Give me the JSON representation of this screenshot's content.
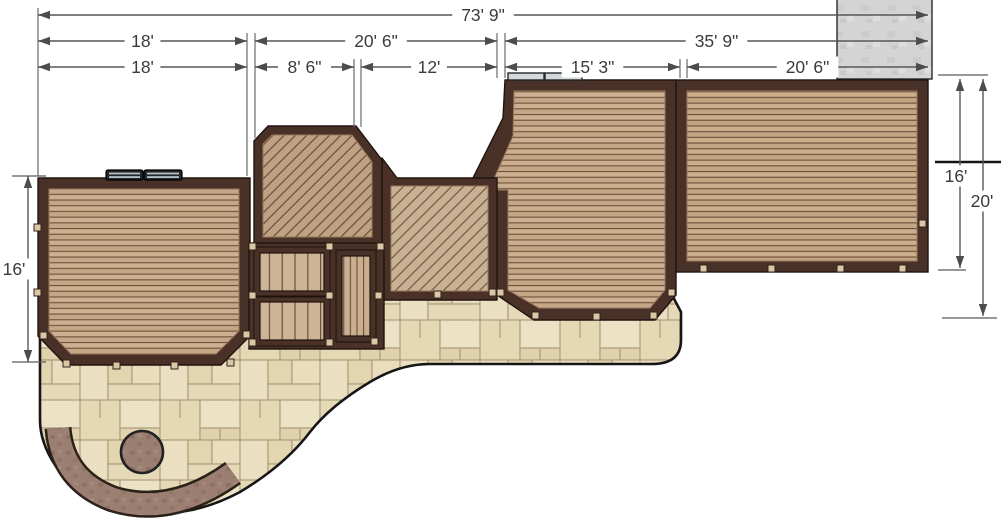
{
  "drawing": {
    "title": "deck-and-patio-plan",
    "colors": {
      "background": "#ffffff",
      "dimension_line": "#575757",
      "dimension_text": "#3b3b3b",
      "deck_border": "#4a3128",
      "deck_boards": "#c9ac8c",
      "diagonal_boards": "#bfa183",
      "patio_pavers": "#e7dcbb",
      "paver_joint": "#a79878",
      "seat_wall": "#9c7f73",
      "concrete_pad": "#d4d4d4",
      "outline_black": "#161616"
    },
    "dimensions": {
      "horizontal": [
        {
          "id": "overall",
          "label": "73' 9\"",
          "x1": 38,
          "x2": 928,
          "y": 15
        },
        {
          "id": "upper-left",
          "label": "18'",
          "x1": 38,
          "x2": 247,
          "y": 41
        },
        {
          "id": "upper-mid",
          "label": "20' 6\"",
          "x1": 255,
          "x2": 497,
          "y": 41
        },
        {
          "id": "upper-right",
          "label": "35' 9\"",
          "x1": 505,
          "x2": 928,
          "y": 41
        },
        {
          "id": "lower-1",
          "label": "18'",
          "x1": 38,
          "x2": 247,
          "y": 67
        },
        {
          "id": "lower-2",
          "label": "8' 6\"",
          "x1": 255,
          "x2": 354,
          "y": 67
        },
        {
          "id": "lower-3",
          "label": "12'",
          "x1": 361,
          "x2": 497,
          "y": 67
        },
        {
          "id": "lower-4",
          "label": "15' 3\"",
          "x1": 505,
          "x2": 680,
          "y": 67
        },
        {
          "id": "lower-5",
          "label": "20' 6\"",
          "x1": 687,
          "x2": 928,
          "y": 67
        }
      ],
      "vertical": [
        {
          "id": "left-height",
          "label": "16'",
          "x": 28,
          "y1": 176,
          "y2": 362,
          "lx": 14,
          "ly": 269
        },
        {
          "id": "right-deck-height",
          "label": "16'",
          "x": 960,
          "y1": 79,
          "y2": 268,
          "lx": 956,
          "ly": 176
        },
        {
          "id": "right-total-height",
          "label": "20'",
          "x": 983,
          "y1": 79,
          "y2": 316,
          "lx": 982,
          "ly": 201
        }
      ],
      "extension_lines": [
        {
          "x": 38,
          "y1": 8,
          "y2": 176
        },
        {
          "x": 247,
          "y1": 33,
          "y2": 176
        },
        {
          "x": 255,
          "y1": 33,
          "y2": 138
        },
        {
          "x": 354,
          "y1": 59,
          "y2": 127
        },
        {
          "x": 361,
          "y1": 59,
          "y2": 127
        },
        {
          "x": 497,
          "y1": 33,
          "y2": 78
        },
        {
          "x": 505,
          "y1": 33,
          "y2": 78
        },
        {
          "x": 680,
          "y1": 59,
          "y2": 78
        },
        {
          "x": 687,
          "y1": 59,
          "y2": 78
        }
      ],
      "ticks": [
        {
          "y": 176,
          "x1": 12,
          "x2": 46
        },
        {
          "y": 362,
          "x1": 12,
          "x2": 46
        },
        {
          "y": 75,
          "x1": 938,
          "x2": 988
        },
        {
          "y": 270,
          "x1": 938,
          "x2": 966
        },
        {
          "y": 318,
          "x1": 942,
          "x2": 997
        }
      ]
    }
  }
}
